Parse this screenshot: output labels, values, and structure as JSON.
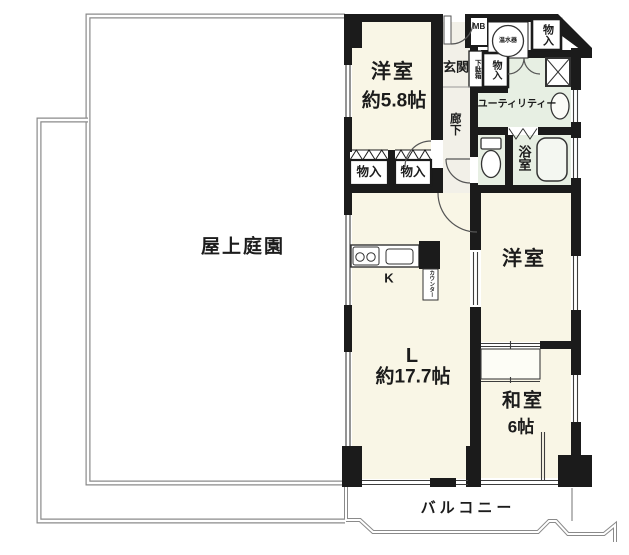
{
  "labels": {
    "roof_garden": "屋上庭園",
    "western_room_1_name": "洋室",
    "western_room_1_size": "約5.8帖",
    "entrance": "玄関",
    "meter_box": "MB",
    "water_heater": "温水器",
    "storage_top_right": "物入",
    "shoe_cabinet": "下駄箱",
    "storage_hall": "物入",
    "utility": "ユーティリティー",
    "corridor": "廊下",
    "bathroom": "浴室",
    "closet_left": "物入",
    "closet_right": "物入",
    "kitchen": "K",
    "counter": "カウンター",
    "living_name": "L",
    "living_size": "約17.7帖",
    "western_room_2_name": "洋室",
    "japanese_room_name": "和室",
    "japanese_room_size": "6帖",
    "balcony": "バルコニー"
  },
  "colors": {
    "wall": "#1b1b1b",
    "room_cream": "#f9f6e6",
    "wet_area_green": "#e7efe3",
    "hall_white": "#f2f0e8",
    "fixture_white": "#ffffff",
    "outline_gray": "#8a8a8a"
  }
}
